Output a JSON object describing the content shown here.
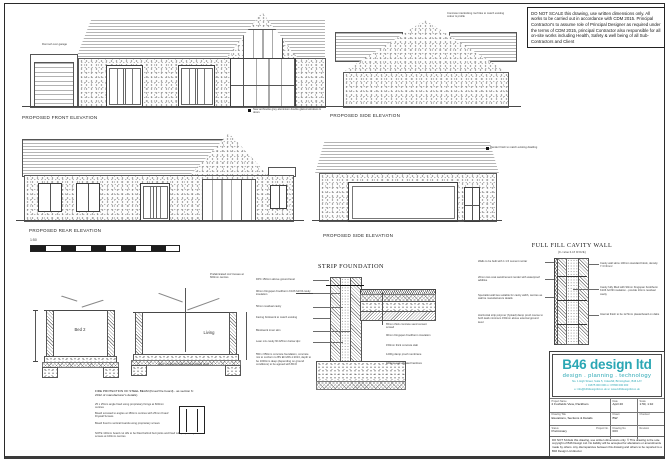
{
  "notes": {
    "top_note": "DO NOT SCALE this drawing, use written dimensions only. All works to be carried out in accordance with CDM 2015. Principal Contractor's to assume role of Principal Designer as required under the terms of CDM 2015, principal Contractor also responsible for all on-site works including Health, Safety & well being of all Sub-Contractors and Client"
  },
  "labels": {
    "front": "PROPOSED FRONT ELEVATION",
    "side_top": "PROPOSED SIDE ELEVATION",
    "rear": "PROPOSED REAR ELEVATION",
    "side_mid": "PROPOSED SIDE ELEVATION",
    "scale": "1:50"
  },
  "annotations": {
    "front_garage": "Flat roof over garage",
    "front_windows": "New anthracite grey aluminium double glazed windows & doors",
    "side_top_roof": "Concrete interlocking roof tiles to match existing colour & profile",
    "side_mid_render": "Render finish to match existing dwelling"
  },
  "sections": {
    "bed_label": "Bed 2",
    "living_label": "Living",
    "roof_note": "Prefabricated roof trusses at 600mm centres",
    "floor_note": "Floor construction as strip foundation detail",
    "fire_title": "FIRE PROTECTION OF STEEL BEAM (Knauf fire board) - as section 6: 2012 of manufacturer's details)",
    "fire_notes": [
      "25 x 25mm angle fixed using proprietary fixings at 600mm centres",
      "Board screwed to angles at 150mm centres with 25mm Knauf Drywall Screws",
      "Board fixed to vertical boards using proprietary screws",
      "NOTE 100mm board cut offs to be fitted behind butt joints and fixed with proprietary screws at 100mm centres"
    ]
  },
  "strip_foundation": {
    "title": "STRIP FOUNDATION",
    "left_notes": [
      "DPC 150mm above ground level",
      "90mm Kingspan Kooltherm K106 full fill cavity insulation",
      "50mm residual cavity",
      "Facing brickwork to match existing",
      "Blockwork inner skin",
      "Lean mix cavity fill 225mm below dpc",
      "550 x 650mm concrete foundation, concrete mix to conform to BS EN 206-1:2013, depth to be 1000mm deep (depending on ground conditions) to be agreed with BCO"
    ],
    "right_notes": [
      "65mm thick concrete sand cement screed",
      "90mm Kingspan Kooltherm insulation",
      "150mm thick concrete slab",
      "1200g damp proof membrane",
      "150mm well vibrated hardcore"
    ]
  },
  "cavity_wall": {
    "title": "FULL FILL CAVITY WALL",
    "subtitle": "(U-value 0.18 W/m²K)",
    "left_notes": [
      "Walls to be built with 1:1:6 cement mortar",
      "20mm two coat sand/cement render with waterproof additive",
      "Specialist wall ties suitable for cavity width, centres as wall tie manufacturers details",
      "Horizontal strip polymer (hyload) damp proof course to both leafs minimum 150mm above external ground level"
    ],
    "right_notes": [
      "Cavity wall skins 100mm standard block, density 7.3 N/mm²",
      "Cavity fully filled with 90mm Kingspan Kooltherm K106 full fill insulation - provide 10mm residual cavity",
      "Internal finish to be 12.5mm plasterboard on dabs"
    ]
  },
  "title_block": {
    "company": "B46 design ltd",
    "tagline": "design . planning . technology",
    "address": "No. 1 High Street, Suite 5, Coleshill, Birmingham, B46 1AY",
    "contact": "t: 01675 000 000    m: 07800 000 000",
    "web": "e: info@b46designltd.co.uk    w: www.b46designltd.co.uk",
    "project_name_label": "Project Name",
    "project_name": "2 Foxfields View, Packham",
    "date_label": "Date",
    "date": "April 20",
    "scale_label": "Scale",
    "scale": "1:50, 1:10",
    "drawing_title_label": "Drawing Title",
    "drawing_title": "Elevations, Sections & Details",
    "drawn_label": "Drawn",
    "drawn": "BW",
    "checked_label": "Checked",
    "checked": "",
    "status_label": "Status",
    "status": "Preliminary",
    "project_no_label": "Project No.",
    "drawing_no_label": "Drawing No.",
    "drawing_no": "003",
    "revision_label": "Revision",
    "revision": "",
    "disclaimer": "DO NOT SCALE this drawing, use written dimensions only. © This drawing is the sole copyright of B46 Design Ltd. No liability will be accepted for alterations or amendments made by others. Any discrepancies between this drawing and others to be reported to a B46 Design Ltd director."
  },
  "colors": {
    "brand": "#2ba7b4",
    "ink": "#333333"
  }
}
